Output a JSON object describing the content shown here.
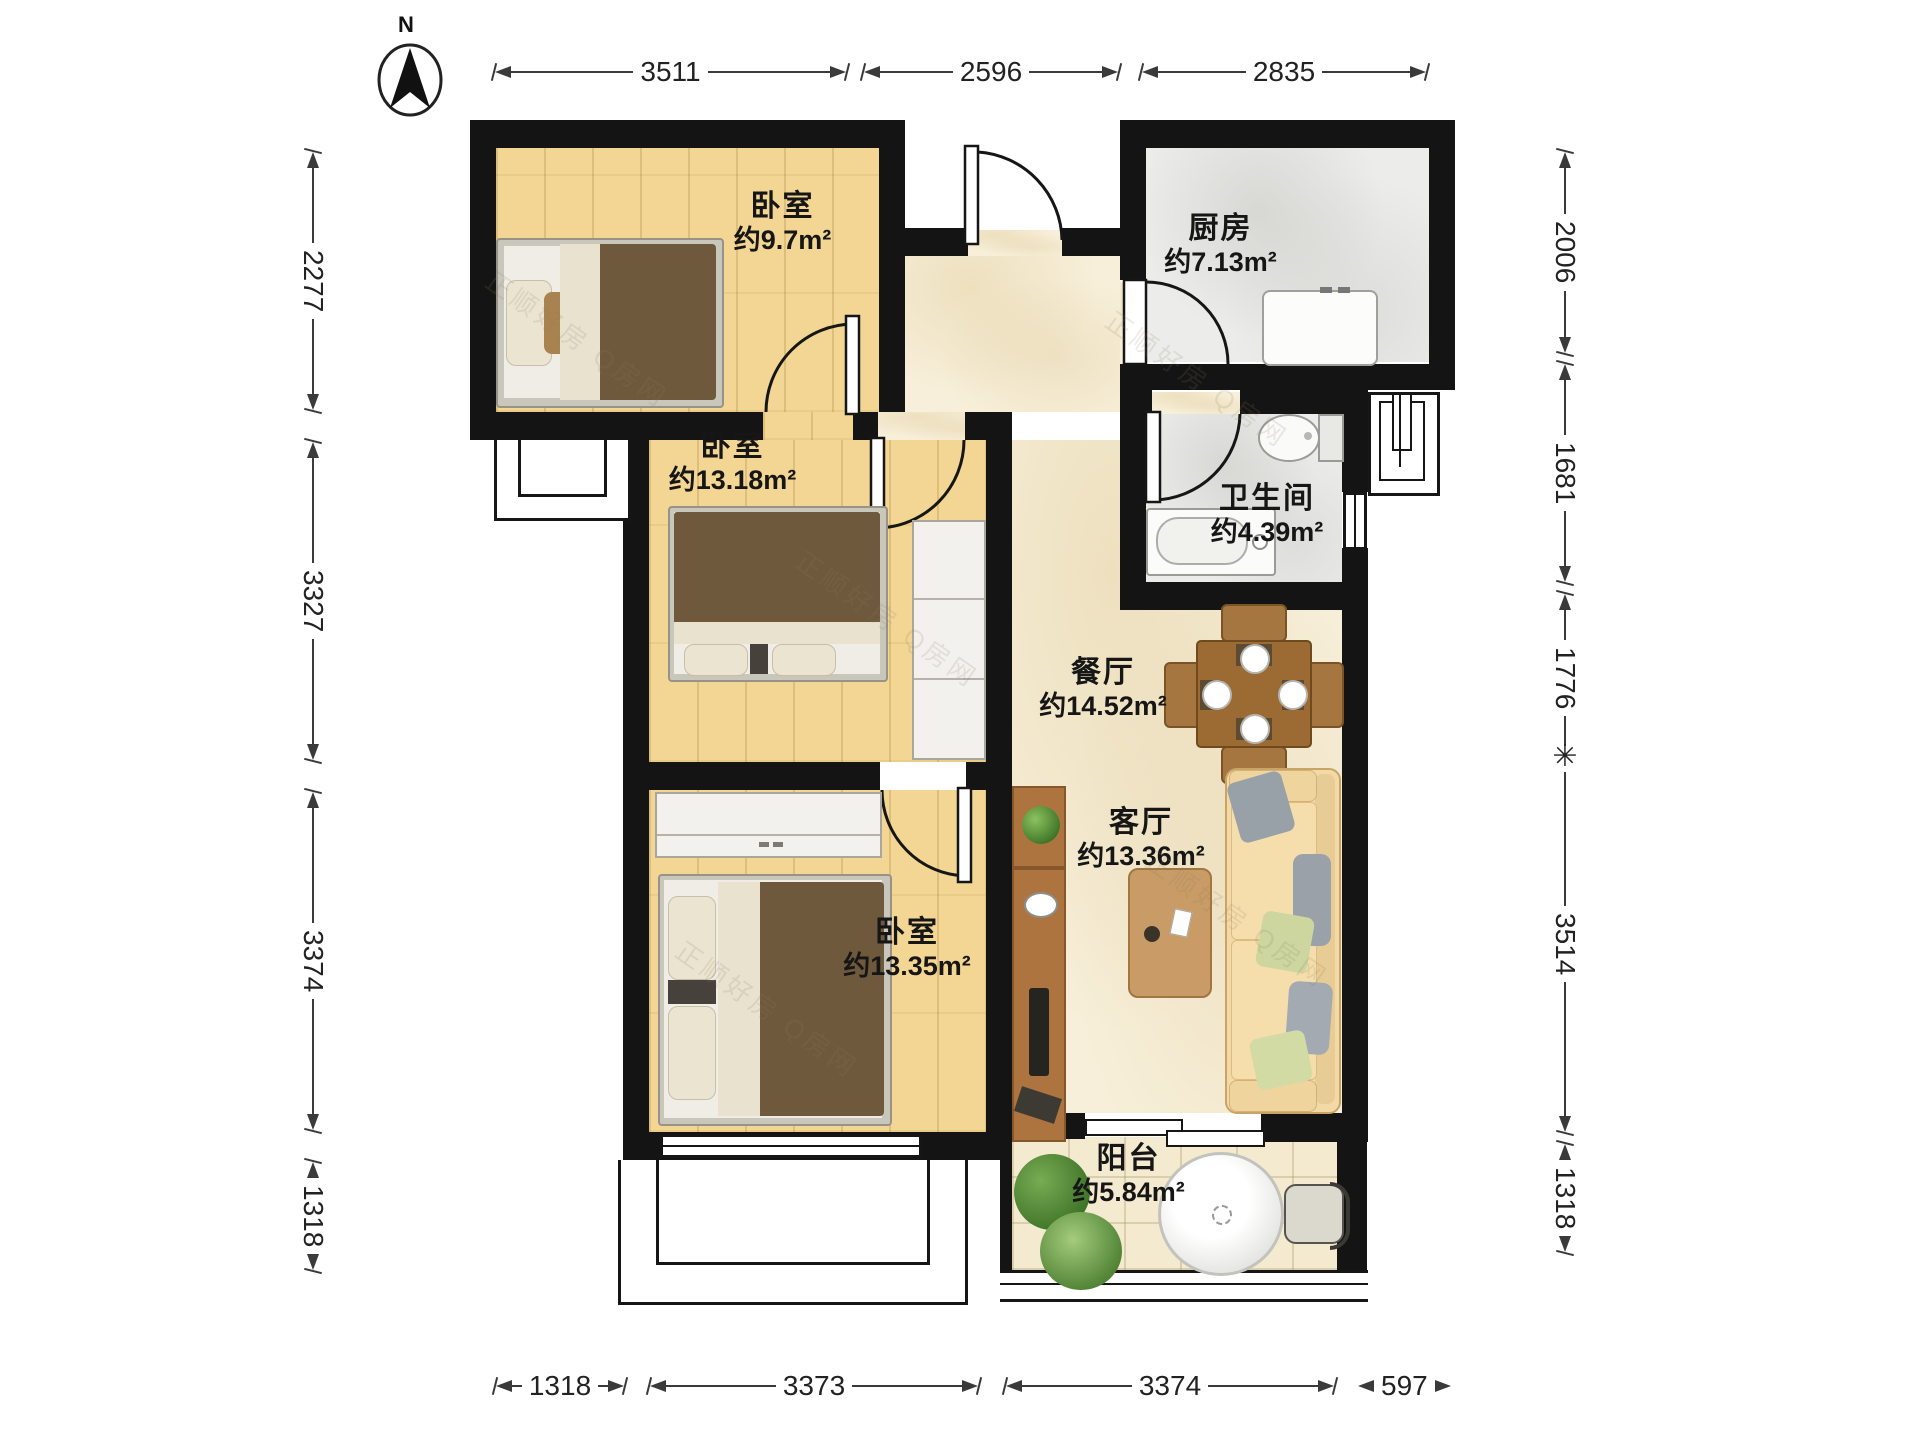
{
  "north": {
    "label": "N"
  },
  "watermark": {
    "text": "正顺好房 Q房网"
  },
  "rooms": [
    {
      "name": "卧室",
      "area": "约9.7m²"
    },
    {
      "name": "厨房",
      "area": "约7.13m²"
    },
    {
      "name": "卧室",
      "area": "约13.18m²"
    },
    {
      "name": "卫生间",
      "area": "约4.39m²"
    },
    {
      "name": "餐厅",
      "area": "约14.52m²"
    },
    {
      "name": "客厅",
      "area": "约13.36m²"
    },
    {
      "name": "卧室",
      "area": "约13.35m²"
    },
    {
      "name": "阳台",
      "area": "约5.84m²"
    }
  ],
  "dimensions": {
    "top": [
      "3511",
      "2596",
      "2835"
    ],
    "bottom": [
      "1318",
      "3373",
      "3374",
      "597"
    ],
    "left": [
      "2277",
      "3327",
      "3374",
      "1318"
    ],
    "right": [
      "2006",
      "1681",
      "1776",
      "3514",
      "1318"
    ],
    "star_tick": "✳"
  }
}
